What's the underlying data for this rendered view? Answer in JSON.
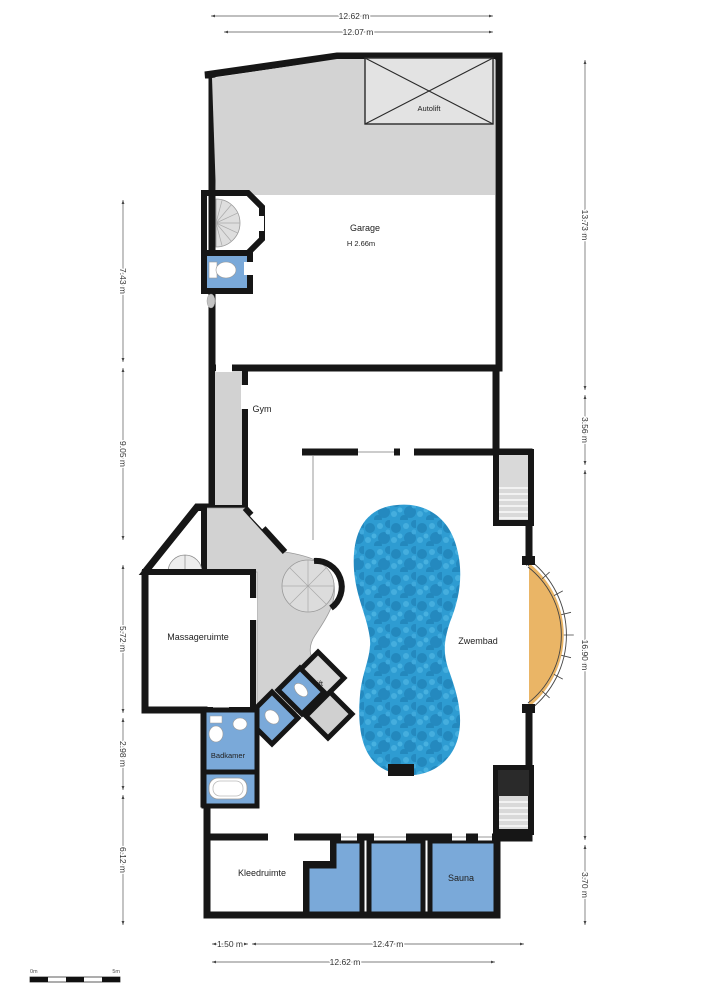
{
  "plan_title": "Floor plan",
  "rooms": {
    "autolift": "Autolift",
    "garage": "Garage",
    "garage_height": "H 2.66m",
    "gym": "Gym",
    "massageruimte": "Massageruimte",
    "zwembad": "Zwembad",
    "lift": "Lift",
    "badkamer": "Badkamer",
    "kleedruimte": "Kleedruimte",
    "sauna": "Sauna"
  },
  "dimensions": {
    "top": [
      "12.62 m",
      "12.07 m"
    ],
    "bottom": [
      "1.50 m",
      "12.47 m",
      "12.62 m"
    ],
    "left": [
      "7.43 m",
      "9.05 m",
      "5.72 m",
      "2.98 m",
      "6.12 m"
    ],
    "right": [
      "13.73 m",
      "3.56 m",
      "16.90 m",
      "3.70 m"
    ]
  },
  "scale_bar": {
    "start": "0m",
    "end": "5m"
  },
  "colors": {
    "floor_orange": "#eab566",
    "room_blue": "#7aa9d9",
    "pool_blue": "#2d9ad0",
    "garage_gray": "#c6c6c6",
    "hall_gray": "#d2d2d2",
    "wall_black": "#161616"
  }
}
